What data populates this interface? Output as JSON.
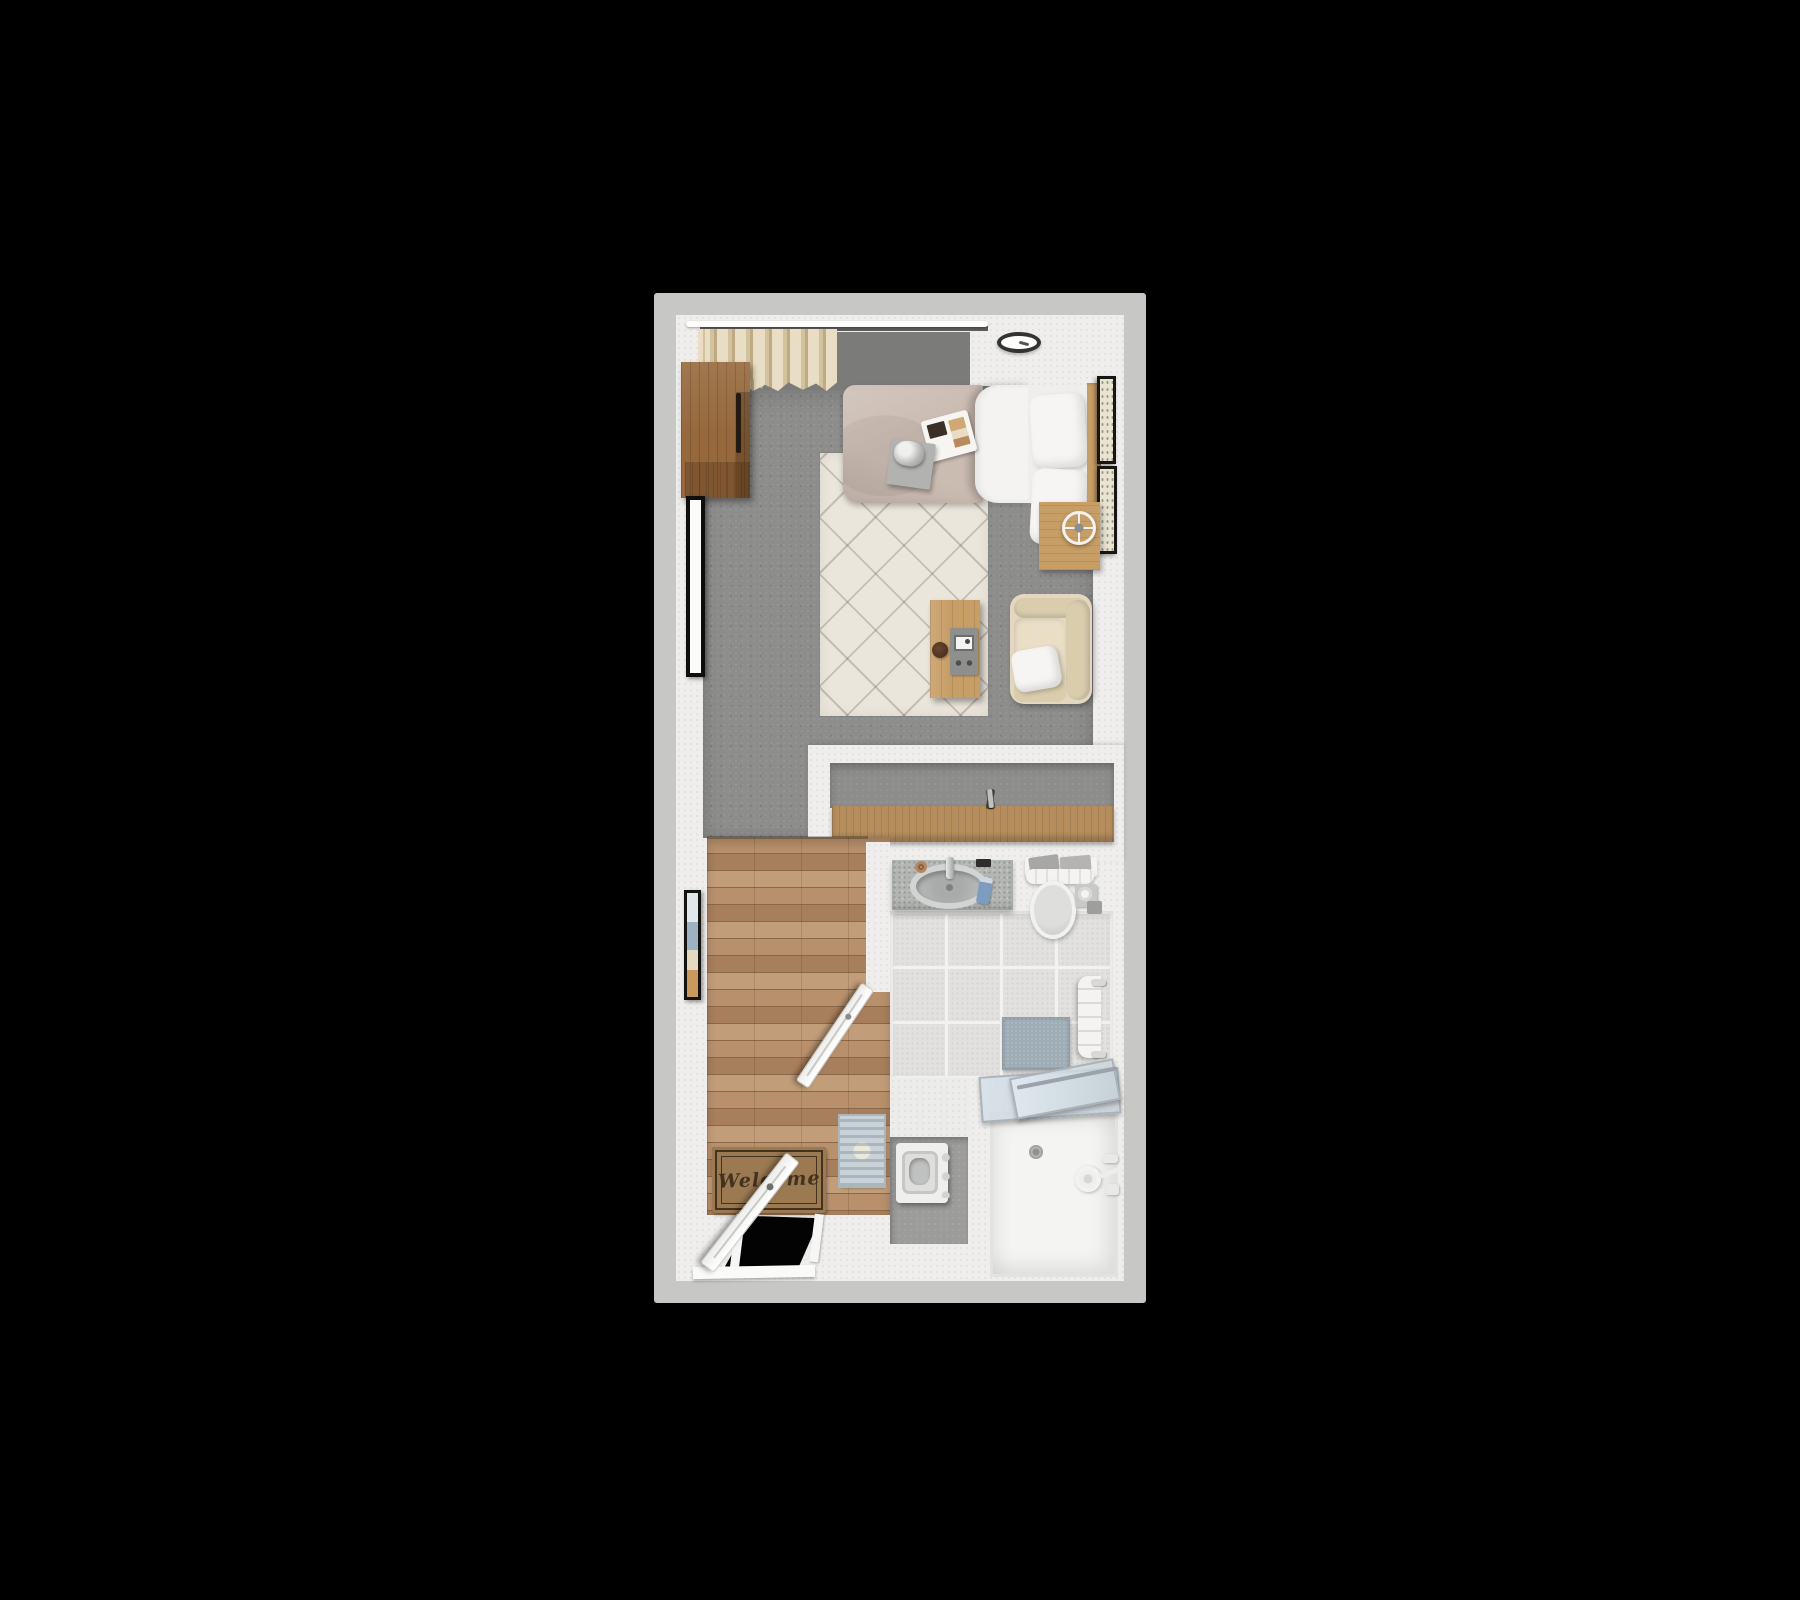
{
  "scene": {
    "type": "3d-floor-plan-top-down-render",
    "description": "Top-down 3D rendering of a studio apartment floor plan on a black background",
    "welcome_mat_text": "Welcome"
  },
  "rooms": [
    {
      "name": "living-bedroom",
      "floor": "gray carpet",
      "items": [
        "curtains along top window wall",
        "curtain rod",
        "ceiling light",
        "wood wardrobe",
        "tall wall mirror",
        "framed wall art",
        "bed with taupe duvet and two white pillows",
        "breakfast tray and box on bed",
        "wood nightstand",
        "wire table lamp",
        "two framed pictures on right wall",
        "cream diamond-pattern area rug",
        "wood coffee table with media device and coaster",
        "beige armchair with white throw pillow"
      ]
    },
    {
      "name": "closet",
      "floor": "gray carpet",
      "items": [
        "wood shelf unit",
        "clothes hangers"
      ]
    },
    {
      "name": "entry-hallway",
      "floor": "wood planks",
      "items": [
        "welcome doormat",
        "blue runner rug",
        "open entry door",
        "open bathroom door",
        "doorway opening"
      ]
    },
    {
      "name": "bathroom",
      "floor": "ceramic tile",
      "items": [
        "granite sink counter",
        "oval sink basin",
        "faucet",
        "soap bottle",
        "toilet with towel on tank",
        "toilet paper holder",
        "blue bath mat",
        "hanging towel",
        "walk-in shower with glass door",
        "shower head and valves",
        "floor drain",
        "washing machine in alcove"
      ]
    }
  ],
  "colors": {
    "bg": "#000000",
    "wall-outer": "#c7c7c5",
    "wall-inner": "#efeeec",
    "floor-gray": "#8d8d8c",
    "floor-gray-dark": "#7b7b7a",
    "wood-a": "#b8916c",
    "wood-b": "#a87f5c",
    "wood-c": "#c29d79",
    "wood-line": "#8a6848",
    "furn-wood": "#c79e66",
    "wood-shelf": "#b68e5d",
    "wardrobe-wood": "#96683c",
    "curtain-a": "#e9dec5",
    "curtain-b": "#d3c29e",
    "curtain-c": "#bfab82",
    "rug-base": "#ebe6db",
    "duvet": "#cbbcb2",
    "linen": "#f4f3f1",
    "pillow-white": "#f6f5f3",
    "armchair-a": "#e3d8bf",
    "armchair-b": "#d9cdae",
    "tile": "#e2e1df",
    "grout": "#f3f2f0",
    "counter": "#b4b6b4",
    "mat-brown": "#9b7a52",
    "mat-ink": "#43321f",
    "runner-base": "#c9d2d6",
    "bath-mat": "#9fadb6",
    "nook-gray": "#9c9c9a",
    "glass-frame": "#aab3ba",
    "metal": "#9aa3ab",
    "black-gap": "#030303"
  }
}
